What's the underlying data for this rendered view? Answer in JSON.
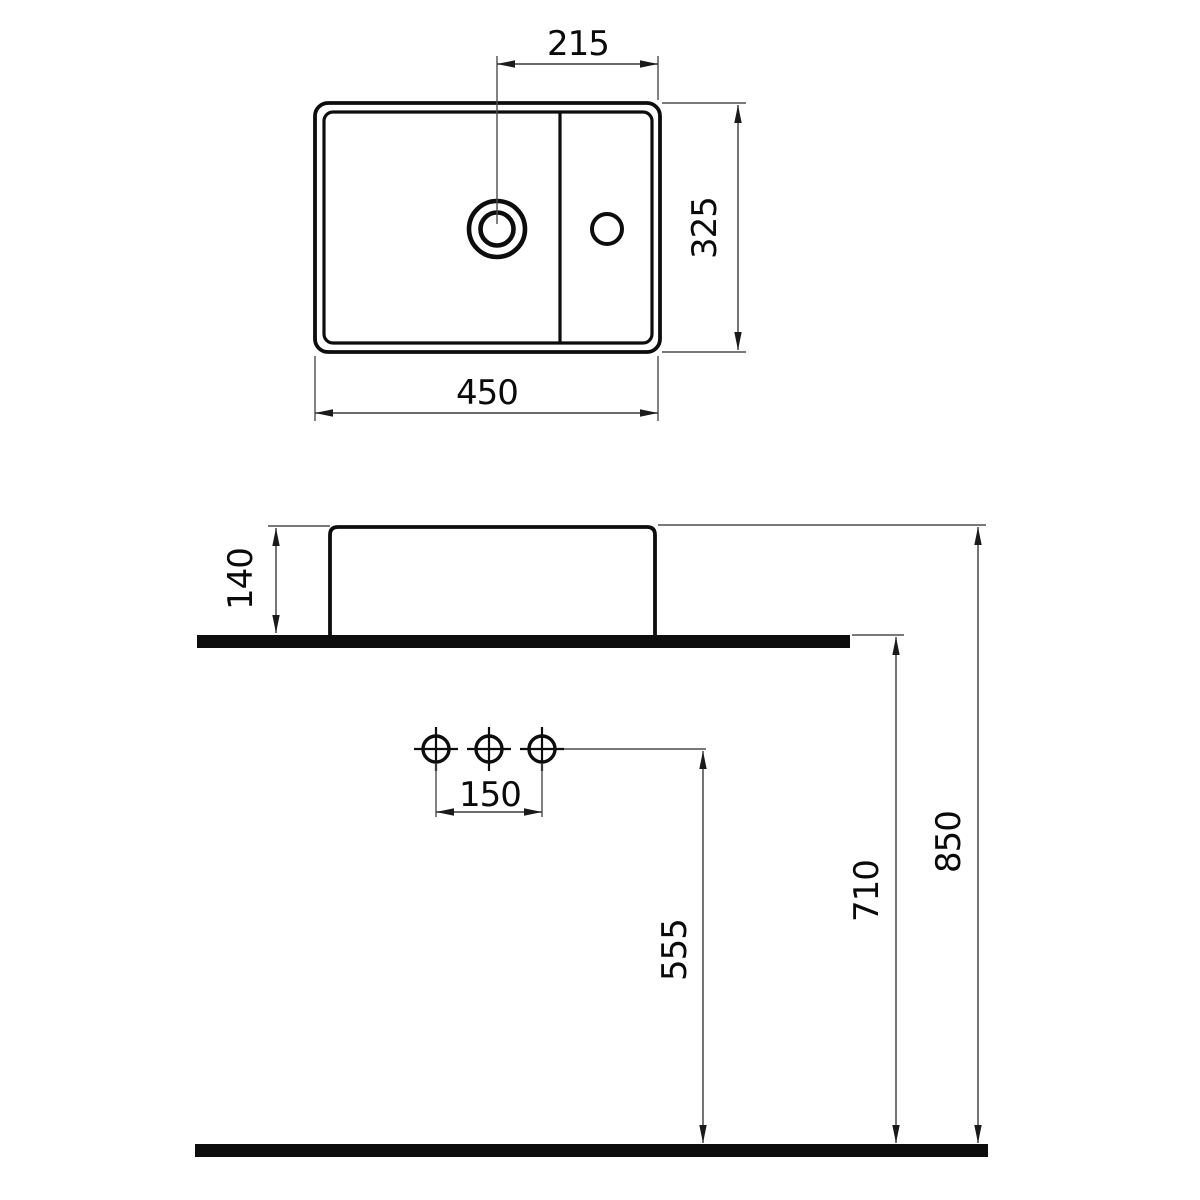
{
  "drawing_type": "washbasin-technical-dimension-drawing",
  "colors": {
    "background": "#ffffff",
    "object_line": "#0d0d0d",
    "thin_line": "#4d4d4d",
    "text": "#0a0a0a"
  },
  "top_view": {
    "tap_hole_offset": "215",
    "depth": "325",
    "width": "450"
  },
  "side_view": {
    "basin_height": "140",
    "hole_spacing": "150",
    "outlet_height": "555",
    "counter_height": "710",
    "rim_height": "850"
  }
}
